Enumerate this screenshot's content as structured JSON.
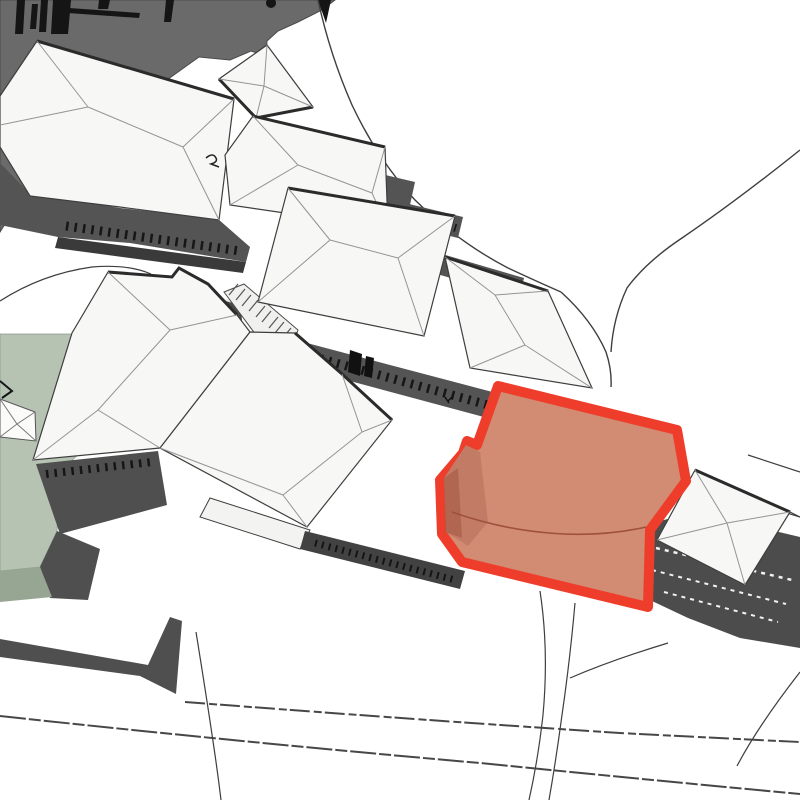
{
  "view": {
    "width": 800,
    "height": 800,
    "background": "#ffffff"
  },
  "highlight": {
    "name": "selected-building",
    "fill": "#d28c73",
    "outline": "#ee3e2b"
  },
  "palette": {
    "ground": "#ffffff",
    "vegetation_dark": "#6a6a6a",
    "roof_white": "#f7f7f6",
    "roof_edge": "#3e3e3e",
    "roof_fold": "#949494",
    "wall_gray": "#545454",
    "wall_dark": "#3a3a3a",
    "field_green": "#b6c3b3",
    "field_green_front": "#97a693",
    "road_line": "#3e3e3e",
    "selection_fill": "#d28c73",
    "selection_outline": "#ee3e2b"
  },
  "scene": {
    "shapes": [
      {
        "name": "hillside-vegetation",
        "type": "polygon",
        "points": "0,0 335,0 322,10 298,22 278,31 267,41 266,56 251,51 230,60 199,57 150,92 99,108 55,150 25,192 0,232",
        "fill": "#6a6a6a",
        "stroke": "#4a4a4a",
        "sw": 1,
        "interactable": false
      },
      {
        "name": "fence-posts",
        "type": "path",
        "d": "M17,0 L25,0 L23,34 L15,34 Z M32,4 L38,4 L36,29 L30,29 Z M41,0 L48,0 L46,32 L39,32 Z M53,0 L71,0 L68,34 L51,34 Z M99,0 L110,0 L108,9 L98,9 Z M166,0 L174,0 L171,22 L164,22 Z",
        "fill": "#151515",
        "interactable": false
      },
      {
        "name": "fence-rail",
        "type": "polygon",
        "points": "69,8 140,13 139,18 68,13",
        "fill": "#151515",
        "interactable": false
      },
      {
        "name": "fence-rail-lower",
        "type": "polygon",
        "points": "6,88 32,97 30,102 4,93",
        "fill": "#151515",
        "interactable": false
      },
      {
        "name": "tree-dot",
        "type": "circle",
        "cx": 271,
        "cy": 3,
        "r": 5,
        "fill": "#151515",
        "interactable": false
      },
      {
        "name": "tree-wedge",
        "type": "polygon",
        "points": "318,0 331,0 326,23",
        "fill": "#151515",
        "interactable": false
      },
      {
        "name": "path-by-field",
        "type": "path",
        "d": "M 0,301 Q 42,274 92,267 Q 128,264 151,274",
        "fill": "none",
        "stroke": "#3e3e3e",
        "sw": 1.2,
        "interactable": false
      },
      {
        "name": "green-field-top",
        "type": "polygon",
        "points": "0,334 72,334 112,416 97,438 60,471 57,531 40,567 0,571",
        "fill": "#b6c3b3",
        "stroke": "#8d9c8a",
        "sw": 0.8,
        "interactable": false
      },
      {
        "name": "green-field-shadow",
        "type": "polygon",
        "points": "57,531 100,549 88,600 50,598 40,567",
        "fill": "#4f4f4f",
        "interactable": false
      },
      {
        "name": "green-field-front",
        "type": "polygon",
        "points": "0,571 40,567 52,597 0,602",
        "fill": "#97a693",
        "interactable": false
      },
      {
        "name": "small-roof-left-edge",
        "type": "polygon",
        "points": "0,399 35,412 36,441 0,437",
        "fill": "#fbfbfa",
        "stroke": "#555555",
        "sw": 1,
        "interactable": false
      },
      {
        "name": "small-roof-left-folds",
        "type": "path",
        "d": "M 0,399 L 17,424 L 35,412 M 0,437 L 17,424 L 36,441",
        "fill": "none",
        "stroke": "#7a7a7a",
        "sw": 1,
        "interactable": false
      },
      {
        "name": "field-corner-mark",
        "type": "path",
        "d": "M 0,381 L 12,391 L 2,398",
        "fill": "none",
        "stroke": "#151515",
        "sw": 2,
        "interactable": false
      },
      {
        "name": "road-upper-north",
        "type": "path",
        "d": "M 318,0 Q 330,55 352,105 Q 378,160 415,200 Q 458,242 508,268 Q 538,282 561,292",
        "fill": "none",
        "stroke": "#3e3e3e",
        "sw": 1.4,
        "interactable": false
      },
      {
        "name": "road-upper-to-selection",
        "type": "path",
        "d": "M 561,292 Q 592,320 606,352 Q 612,370 611,387",
        "fill": "none",
        "stroke": "#3e3e3e",
        "sw": 1.4,
        "interactable": false
      },
      {
        "name": "road-northeast",
        "type": "path",
        "d": "M 800,150 Q 735,202 682,238 Q 646,262 627,288 Q 613,318 611,352",
        "fill": "none",
        "stroke": "#3e3e3e",
        "sw": 1.4,
        "interactable": false
      },
      {
        "name": "road-east-edge-1",
        "type": "path",
        "d": "M 748,455 L 800,472",
        "fill": "none",
        "stroke": "#3e3e3e",
        "sw": 1.2,
        "interactable": false
      },
      {
        "name": "road-east-edge-2",
        "type": "path",
        "d": "M 745,500 L 800,517",
        "fill": "none",
        "stroke": "#3e3e3e",
        "sw": 1.2,
        "interactable": false
      },
      {
        "name": "road-below-selection-1",
        "type": "path",
        "d": "M 540,591 Q 549,650 543,715 Q 538,760 529,800",
        "fill": "none",
        "stroke": "#3e3e3e",
        "sw": 1.2,
        "interactable": false
      },
      {
        "name": "road-below-selection-2",
        "type": "path",
        "d": "M 575,603 Q 570,660 562,715 Q 556,760 549,800",
        "fill": "none",
        "stroke": "#3e3e3e",
        "sw": 1.2,
        "interactable": false
      },
      {
        "name": "road-stairs-link",
        "type": "path",
        "d": "M 668,643 Q 612,660 570,678",
        "fill": "none",
        "stroke": "#3e3e3e",
        "sw": 1.2,
        "interactable": false
      },
      {
        "name": "road-bottom-right-curve",
        "type": "path",
        "d": "M 800,672 Q 758,726 737,766",
        "fill": "none",
        "stroke": "#3e3e3e",
        "sw": 1.2,
        "interactable": false
      },
      {
        "name": "road-bottom-edge-1",
        "type": "path",
        "d": "M 185,702 Q 420,720 620,733 Q 716,738 800,742",
        "fill": "none",
        "stroke": "#474747",
        "sw": 2,
        "dash": "20 4 8 3",
        "interactable": false
      },
      {
        "name": "road-bottom-edge-2",
        "type": "path",
        "d": "M 0,716 Q 240,742 480,763 Q 650,780 800,794",
        "fill": "none",
        "stroke": "#474747",
        "sw": 2,
        "dash": "26 3 12 3",
        "interactable": false
      },
      {
        "name": "road-bottom-left",
        "type": "path",
        "d": "M 196,632 Q 207,700 214,748 Q 218,775 221,800",
        "fill": "none",
        "stroke": "#3e3e3e",
        "sw": 1.2,
        "interactable": false
      },
      {
        "name": "retaining-wall-bottom-left",
        "type": "polygon",
        "points": "0,639 148,665 170,617 182,621 176,694 140,676 0,657",
        "fill": "#4f4f4f",
        "interactable": false
      },
      {
        "name": "wall-band-building-a",
        "type": "polygon",
        "points": "0,163 28,192 120,208 218,219 250,247 246,262 130,243 58,237 0,225",
        "fill": "#545454",
        "interactable": false
      },
      {
        "name": "wall-base-building-a",
        "type": "polygon",
        "points": "58,237 246,262 243,273 55,248",
        "fill": "#3a3a3a",
        "interactable": false
      },
      {
        "name": "windows-building-a",
        "type": "path",
        "d": "M 66,226 L 240,251",
        "fill": "none",
        "stroke": "#161616",
        "sw": 9,
        "dash": "2.5 6",
        "interactable": false
      },
      {
        "name": "wall-band-building-b",
        "type": "polygon",
        "points": "368,171 415,182 410,205 363,194",
        "fill": "#545454",
        "interactable": false
      },
      {
        "name": "wall-band-building-c",
        "type": "polygon",
        "points": "376,196 463,217 458,238 371,216",
        "fill": "#545454",
        "interactable": false
      },
      {
        "name": "windows-building-c",
        "type": "path",
        "d": "M 381,206 L 456,228",
        "fill": "none",
        "stroke": "#161616",
        "sw": 8,
        "dash": "2.5 6",
        "interactable": false
      },
      {
        "name": "wall-band-building-c2",
        "type": "polygon",
        "points": "442,254 524,278 519,298 437,274",
        "fill": "#545454",
        "interactable": false
      },
      {
        "name": "windows-building-c2",
        "type": "path",
        "d": "M 447,263 L 516,284",
        "fill": "none",
        "stroke": "#161616",
        "sw": 7,
        "dash": "2.5 6",
        "interactable": false
      },
      {
        "name": "wall-band-courtyard",
        "type": "polygon",
        "points": "288,338 500,394 495,420 283,363",
        "fill": "#545454",
        "interactable": false
      },
      {
        "name": "windows-courtyard",
        "type": "path",
        "d": "M 296,352 L 488,405",
        "fill": "none",
        "stroke": "#161616",
        "sw": 9,
        "dash": "2.5 6",
        "interactable": false
      },
      {
        "name": "window-dark-1",
        "type": "polygon",
        "points": "350,350 362,354 360,376 348,372",
        "fill": "#111111",
        "interactable": false
      },
      {
        "name": "window-dark-2",
        "type": "polygon",
        "points": "366,356 374,358 372,378 364,376",
        "fill": "#111111",
        "interactable": false
      },
      {
        "name": "stair-tower",
        "type": "polygon",
        "points": "208,295 240,304 246,352 228,360 212,344",
        "fill": "#4a4a4a",
        "interactable": false
      },
      {
        "name": "stair-tower-top-edge",
        "type": "path",
        "d": "M 208,295 L 240,304",
        "fill": "none",
        "stroke": "#ededed",
        "sw": 2,
        "interactable": false
      },
      {
        "name": "wall-band-west",
        "type": "polygon",
        "points": "36,464 158,451 167,505 60,534",
        "fill": "#4f4f4f",
        "interactable": false
      },
      {
        "name": "windows-west",
        "type": "path",
        "d": "M 46,474 L 152,462",
        "fill": "none",
        "stroke": "#161616",
        "sw": 8,
        "dash": "2.5 6",
        "interactable": false
      },
      {
        "name": "ramp-walkway",
        "type": "polygon",
        "points": "224,292 244,284 298,330 292,347 262,343",
        "fill": "#f0f0ef",
        "stroke": "#4a4a4a",
        "sw": 1,
        "interactable": false
      },
      {
        "name": "ramp-steps",
        "type": "path",
        "d": "M 238,284 L 229,295 M 245,289 L 236,300 M 251,295 L 242,306 M 258,300 L 249,311 M 265,306 L 256,317 M 271,311 L 262,322 M 278,317 L 269,328 M 284,322 L 275,333 M 291,328 L 282,339",
        "fill": "none",
        "stroke": "#555555",
        "sw": 1.2,
        "interactable": false
      },
      {
        "name": "roof-building-a",
        "type": "polygon",
        "points": "37,41 234,99 219,220 120,207 30,196 0,147 0,96",
        "fill": "#f7f7f6",
        "stroke": "#3e3e3e",
        "sw": 1.2,
        "interactable": false
      },
      {
        "name": "roof-a-eave-shadow",
        "type": "path",
        "d": "M 37,41 L 234,99",
        "fill": "none",
        "stroke": "#2b2b2b",
        "sw": 3,
        "interactable": false
      },
      {
        "name": "roof-a-folds",
        "type": "path",
        "d": "M 88,107 L 183,147 M 37,41 L 88,107 M 0,125 L 88,107 M 234,99 L 183,147 M 219,220 L 183,147",
        "fill": "none",
        "stroke": "#949494",
        "sw": 1,
        "interactable": false
      },
      {
        "name": "roof-building-b1",
        "type": "polygon",
        "points": "267,45 313,107 256,118 219,79",
        "fill": "#f7f7f6",
        "stroke": "#3e3e3e",
        "sw": 1.2,
        "interactable": false
      },
      {
        "name": "roof-b1-eave-shadow",
        "type": "path",
        "d": "M 219,79 L 256,118 L 313,107",
        "fill": "none",
        "stroke": "#2b2b2b",
        "sw": 3,
        "interactable": false
      },
      {
        "name": "roof-b1-folds",
        "type": "path",
        "d": "M 267,45 L 264,86 M 313,107 L 264,86 M 256,118 L 264,86 M 219,79 L 264,86",
        "fill": "none",
        "stroke": "#949494",
        "sw": 1,
        "interactable": false
      },
      {
        "name": "roof-building-b2",
        "type": "polygon",
        "points": "253,116 385,147 388,228 230,205 225,155",
        "fill": "#f7f7f6",
        "stroke": "#3e3e3e",
        "sw": 1.2,
        "interactable": false
      },
      {
        "name": "roof-b2-eave-shadow",
        "type": "path",
        "d": "M 253,116 L 385,147",
        "fill": "none",
        "stroke": "#2b2b2b",
        "sw": 3,
        "interactable": false
      },
      {
        "name": "roof-b2-folds",
        "type": "path",
        "d": "M 298,165 L 372,193 M 253,116 L 298,165 M 385,147 L 372,193 M 230,205 L 298,165 M 388,228 L 372,193",
        "fill": "none",
        "stroke": "#949494",
        "sw": 1,
        "interactable": false
      },
      {
        "name": "roof-building-c",
        "type": "polygon",
        "points": "288,188 455,216 424,336 258,302",
        "fill": "#f7f7f6",
        "stroke": "#3e3e3e",
        "sw": 1.2,
        "interactable": false
      },
      {
        "name": "roof-c-eave-shadow",
        "type": "path",
        "d": "M 288,188 L 455,216",
        "fill": "none",
        "stroke": "#2b2b2b",
        "sw": 3,
        "interactable": false
      },
      {
        "name": "roof-c-folds",
        "type": "path",
        "d": "M 330,240 L 398,258 M 288,188 L 330,240 M 258,302 L 330,240 M 455,216 L 398,258 M 424,336 L 398,258",
        "fill": "none",
        "stroke": "#949494",
        "sw": 1,
        "interactable": false
      },
      {
        "name": "roof-building-c2",
        "type": "polygon",
        "points": "445,257 548,291 592,388 470,368",
        "fill": "#f7f7f6",
        "stroke": "#3e3e3e",
        "sw": 1.2,
        "interactable": false
      },
      {
        "name": "roof-c2-eave-shadow",
        "type": "path",
        "d": "M 445,257 L 548,291",
        "fill": "none",
        "stroke": "#2b2b2b",
        "sw": 3,
        "interactable": false
      },
      {
        "name": "roof-c2-folds",
        "type": "path",
        "d": "M 495,295 L 525,345 M 445,257 L 495,295 M 548,291 L 495,295 M 592,388 L 525,345 M 470,368 L 525,345",
        "fill": "none",
        "stroke": "#949494",
        "sw": 1,
        "interactable": false
      },
      {
        "name": "roof-building-d1",
        "type": "polygon",
        "points": "108,272 172,277 179,268 208,284 237,315 250,332 160,448 33,460 72,333",
        "fill": "#f7f7f6",
        "stroke": "#3e3e3e",
        "sw": 1.2,
        "interactable": false
      },
      {
        "name": "roof-d1-eave-shadow",
        "type": "path",
        "d": "M 108,272 L 172,277 L 179,268 L 208,284 L 237,315",
        "fill": "none",
        "stroke": "#2b2b2b",
        "sw": 3,
        "interactable": false
      },
      {
        "name": "roof-d1-folds",
        "type": "path",
        "d": "M 98,410 L 170,330 M 33,460 L 98,410 M 160,448 L 98,410 M 108,272 L 170,330 M 237,315 L 170,330",
        "fill": "none",
        "stroke": "#949494",
        "sw": 1,
        "interactable": false
      },
      {
        "name": "roof-building-d2",
        "type": "polygon",
        "points": "250,332 295,333 342,374 392,420 307,527 160,448",
        "fill": "#f7f7f6",
        "stroke": "#3e3e3e",
        "sw": 1.2,
        "interactable": false
      },
      {
        "name": "roof-d2-eave-shadow",
        "type": "path",
        "d": "M 295,333 L 342,374 L 392,420",
        "fill": "none",
        "stroke": "#2b2b2b",
        "sw": 3,
        "interactable": false
      },
      {
        "name": "roof-d2-folds",
        "type": "path",
        "d": "M 283,495 L 362,432 M 160,448 L 283,495 M 307,527 L 283,495 M 342,374 L 362,432 M 392,420 L 362,432",
        "fill": "none",
        "stroke": "#949494",
        "sw": 1,
        "interactable": false
      },
      {
        "name": "porch-canopy",
        "type": "polygon",
        "points": "210,498 310,530 300,549 200,517",
        "fill": "#f3f3f2",
        "stroke": "#3e3e3e",
        "sw": 1,
        "interactable": false
      },
      {
        "name": "porch-wall-dark",
        "type": "polygon",
        "points": "305,531 465,571 460,589 300,549",
        "fill": "#424242",
        "interactable": false
      },
      {
        "name": "porch-windows",
        "type": "path",
        "d": "M 315,543 L 455,580",
        "fill": "none",
        "stroke": "#141414",
        "sw": 7,
        "dash": "2 5",
        "interactable": false
      },
      {
        "name": "roof-annotation-mark",
        "type": "path",
        "d": "M 206,158 q 7,-6 10,0 q 2,4 -5,6 l 8,3",
        "fill": "none",
        "stroke": "#222222",
        "sw": 1.5,
        "interactable": false
      },
      {
        "name": "roof-small-mark",
        "type": "path",
        "d": "M 445,397 l 4,6 m -1,-2 l 4,-4",
        "fill": "none",
        "stroke": "#111111",
        "sw": 1.5,
        "interactable": false
      },
      {
        "name": "stairs-terrace-east",
        "type": "polygon",
        "points": "645,525 694,512 800,537 800,648 740,638 688,618 652,601",
        "fill": "#4c4c4c",
        "interactable": false
      },
      {
        "name": "stairs-treads-1",
        "type": "path",
        "d": "M 656,548 L 792,580",
        "fill": "none",
        "stroke": "#f2f2f2",
        "sw": 2.5,
        "dash": "4 5",
        "interactable": false
      },
      {
        "name": "stairs-treads-2",
        "type": "path",
        "d": "M 652,570 L 786,604",
        "fill": "none",
        "stroke": "#f2f2f2",
        "sw": 2,
        "dash": "4 5",
        "interactable": false
      },
      {
        "name": "stairs-treads-3",
        "type": "path",
        "d": "M 664,592 L 778,622",
        "fill": "none",
        "stroke": "#f2f2f2",
        "sw": 2,
        "dash": "4 5",
        "interactable": false
      },
      {
        "name": "roof-pavilion-east",
        "type": "polygon",
        "points": "695,470 790,512 745,585 657,540",
        "fill": "#f7f7f6",
        "stroke": "#3e3e3e",
        "sw": 1.2,
        "interactable": false
      },
      {
        "name": "roof-pavilion-eave-shadow",
        "type": "path",
        "d": "M 695,470 L 790,512",
        "fill": "none",
        "stroke": "#2b2b2b",
        "sw": 3,
        "interactable": false
      },
      {
        "name": "roof-pavilion-folds",
        "type": "path",
        "d": "M 695,470 L 727,523 M 790,512 L 727,523 M 745,585 L 727,523 M 657,540 L 727,523",
        "fill": "none",
        "stroke": "#949494",
        "sw": 1,
        "interactable": false
      },
      {
        "name": "roof-pavilion-ext-line",
        "type": "path",
        "d": "M 790,512 L 800,517",
        "fill": "none",
        "stroke": "#3e3e3e",
        "sw": 1.2,
        "interactable": false
      },
      {
        "name": "selected-building-highlight",
        "type": "polygon",
        "points": "498,386 677,430 686,481 650,530 648,607 462,562 442,534 440,480 463,453 467,441 477,445",
        "fill": "#d28c73",
        "stroke": "#ee3e2b",
        "sw": 10,
        "round": true,
        "interactable": true
      },
      {
        "name": "selected-building-side-facet",
        "type": "polygon",
        "points": "444,478 466,445 480,452 488,522 468,546 446,532",
        "fill": "#c27c66",
        "interactable": false
      },
      {
        "name": "selected-building-shadow",
        "type": "polygon",
        "points": "444,478 458,468 462,538 445,532",
        "fill": "#a35440",
        "opacity": 0.55,
        "interactable": false
      },
      {
        "name": "selected-building-roof-break",
        "type": "path",
        "d": "M 452,512 C 520,536 590,540 646,527",
        "fill": "none",
        "stroke": "#9e513d",
        "sw": 1.6,
        "interactable": false
      }
    ]
  }
}
